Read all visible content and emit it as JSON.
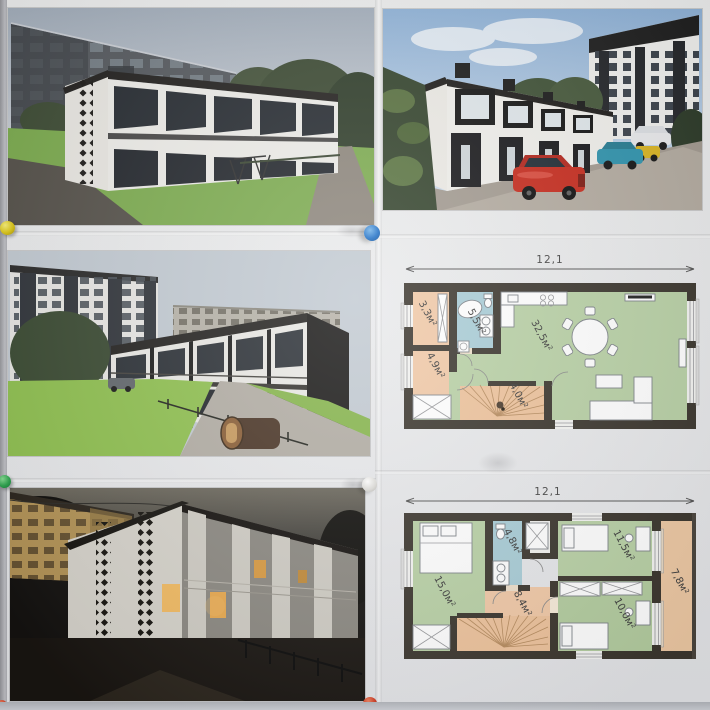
{
  "colors": {
    "board": "#d8d9dd",
    "paper": "#ebecee",
    "wall_dark": "#3b362e",
    "room_green": "#b9d1a6",
    "room_peach": "#f1c9a7",
    "room_blue": "#a9cdd7",
    "terrace_peach": "#eec9a4",
    "pin_yellow": "#ddc715",
    "pin_blue": "#2272c8",
    "pin_green": "#2da44e",
    "pin_white": "#dcdbd7",
    "pin_red": "#cf3a22"
  },
  "panels": {
    "top_left": "townhouse-render-corner-view-day",
    "top_right": "townhouse-render-front-view-with-cars",
    "middle_left": "townhouse-render-courtyard-view",
    "bottom_left": "townhouse-render-evening-view"
  },
  "plan_first_floor": {
    "dimension_label": "12,1",
    "rooms": [
      {
        "id": "pantry",
        "label": "3,3м²"
      },
      {
        "id": "bathroom",
        "label": "5,5м²"
      },
      {
        "id": "hallway",
        "label": "4,9м²"
      },
      {
        "id": "stairs",
        "label": "4,0м²"
      },
      {
        "id": "living-kitchen",
        "label": "32,5м²"
      }
    ]
  },
  "plan_second_floor": {
    "dimension_label": "12,1",
    "rooms": [
      {
        "id": "bedroom-master",
        "label": "15,0м²"
      },
      {
        "id": "bathroom",
        "label": "4,8м²"
      },
      {
        "id": "bedroom-2",
        "label": "11,5м²"
      },
      {
        "id": "hallway",
        "label": "8,4м²"
      },
      {
        "id": "bedroom-3",
        "label": "10,0м²"
      },
      {
        "id": "terrace",
        "label": "7,8м²"
      }
    ]
  }
}
